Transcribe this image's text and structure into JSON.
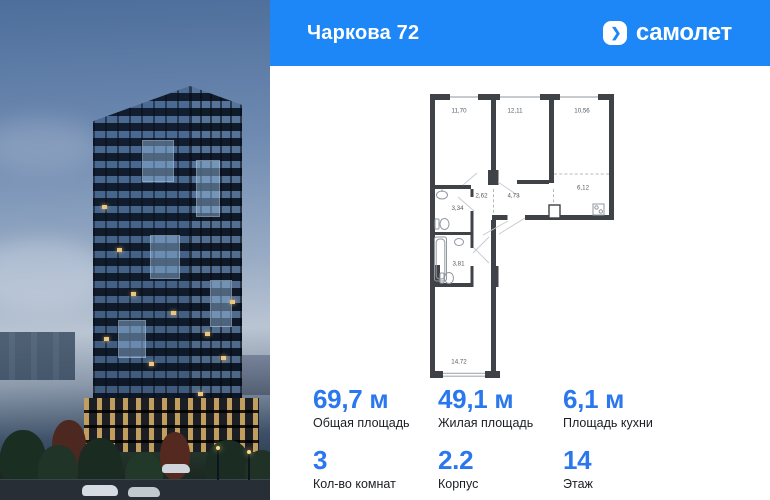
{
  "header": {
    "title": "Чаркова 72",
    "brand": "самолет",
    "brand_chevron": "❯"
  },
  "floorplan": {
    "rooms": [
      {
        "name": "bedroom-1",
        "area": "11,70"
      },
      {
        "name": "bedroom-2",
        "area": "12,11"
      },
      {
        "name": "living-room",
        "area": "10,56"
      },
      {
        "name": "kitchen",
        "area": "6,12"
      },
      {
        "name": "hallway",
        "area": "4,73"
      },
      {
        "name": "corridor",
        "area": "2,62"
      },
      {
        "name": "wc",
        "area": "3,34"
      },
      {
        "name": "bathroom",
        "area": "3,81"
      },
      {
        "name": "room-long",
        "area": "14,72"
      }
    ]
  },
  "stats": {
    "cells": [
      {
        "value": "69,7 м",
        "label": "Общая площадь"
      },
      {
        "value": "49,1 м",
        "label": "Жилая площадь"
      },
      {
        "value": "6,1 м",
        "label": "Площадь кухни"
      },
      {
        "value": "3",
        "label": "Кол-во комнат"
      },
      {
        "value": "2.2",
        "label": "Корпус"
      },
      {
        "value": "14",
        "label": "Этаж"
      }
    ]
  },
  "colors": {
    "header_blue": "#1e87f8",
    "value_blue": "#2b77ee",
    "plan_wall": "#3f4347"
  }
}
